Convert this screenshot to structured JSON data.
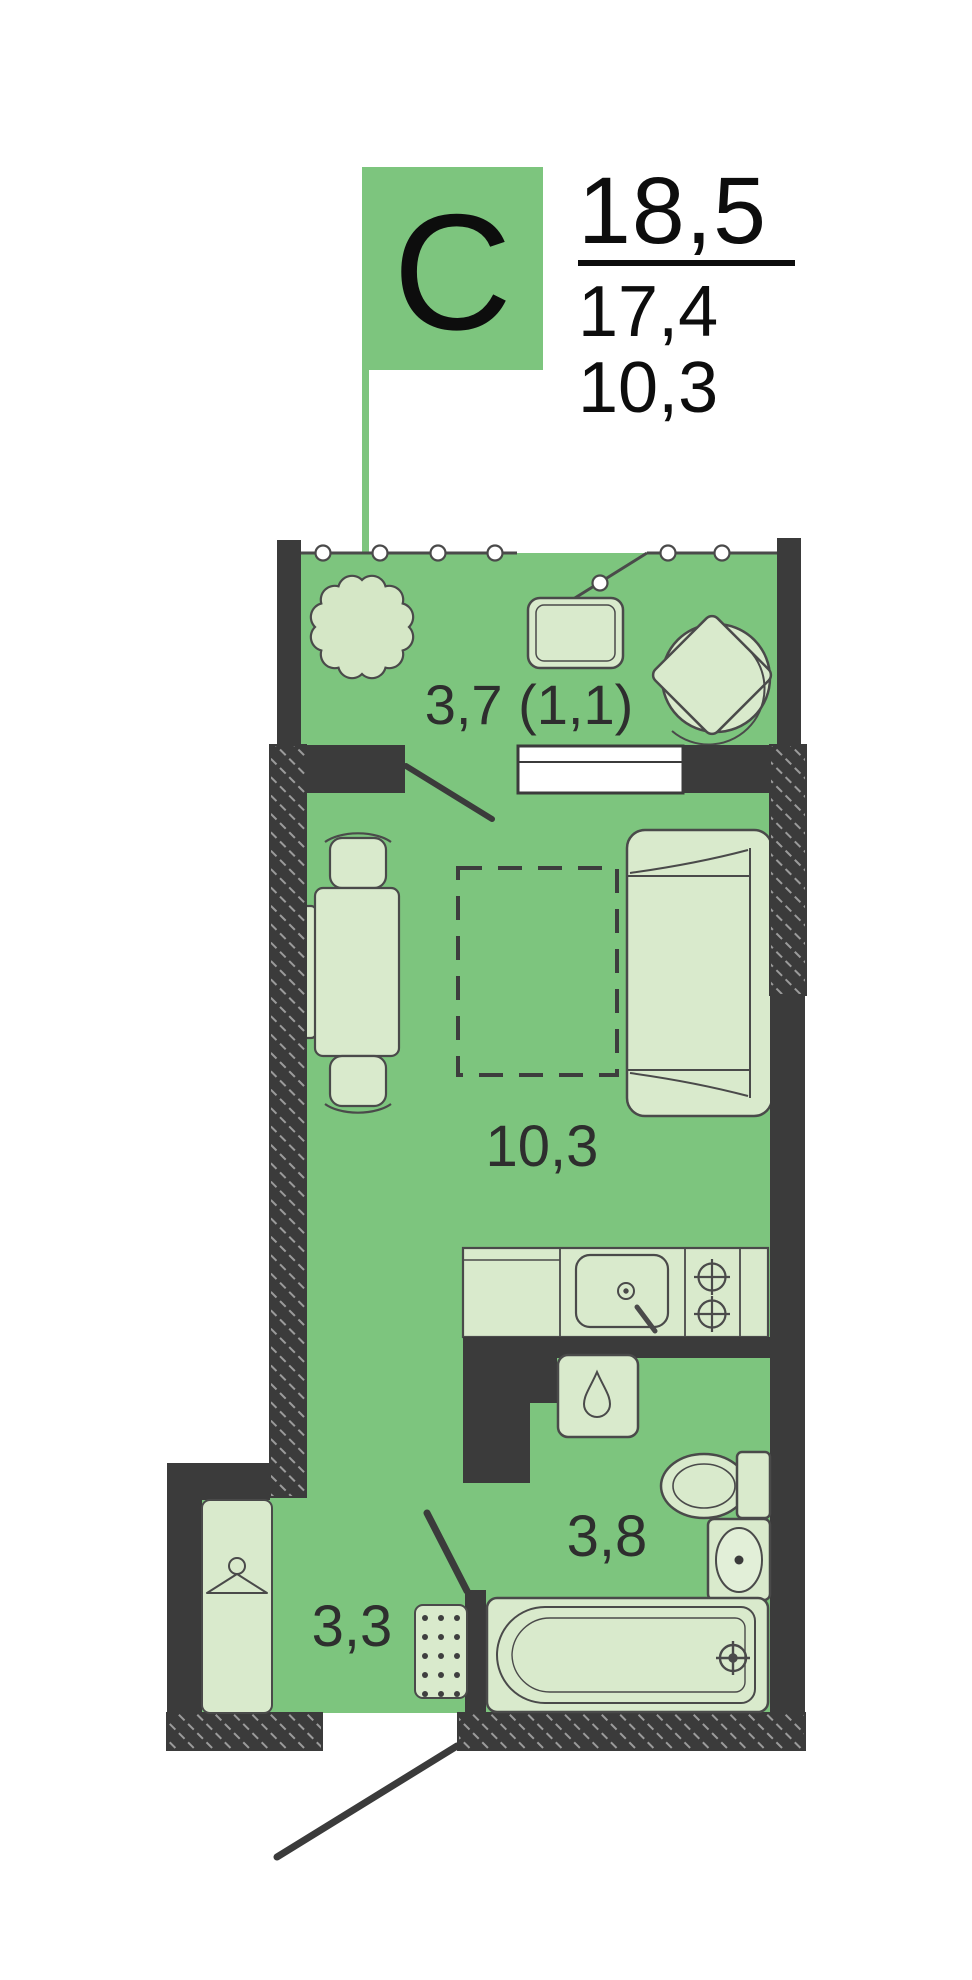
{
  "legend": {
    "type_letter": "С",
    "area_total": "18,5",
    "area_living": "17,4",
    "area_main_room": "10,3"
  },
  "plan": {
    "labels": {
      "balcony": "3,7 (1,1)",
      "living_room": "10,3",
      "bathroom": "3,8",
      "hallway": "3,3"
    }
  },
  "colors": {
    "floor_green": "#7dc57e",
    "flag_green": "#7dc57e",
    "furniture_fill": "#d9eacc",
    "tree_fill": "#d5e7c6",
    "wall_dark": "#3b3b3b",
    "outline": "#4a4a4a",
    "window_fill": "#ffffff",
    "text": "#2e2e2e",
    "title_text": "#0d0d0d"
  }
}
